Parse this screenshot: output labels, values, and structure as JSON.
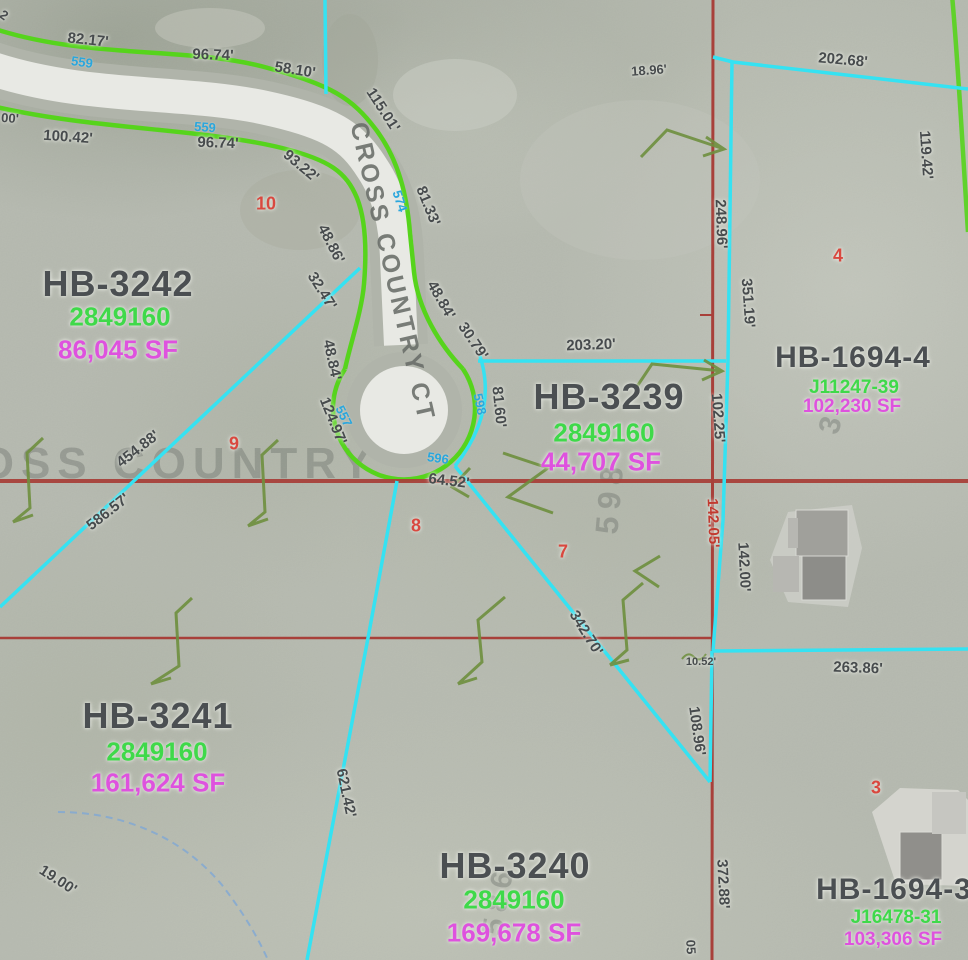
{
  "map_type": "parcel-gis-aerial",
  "colors": {
    "parcel_boundary_cyan": "#35e2f2",
    "section_line_red": "#a8403a",
    "road_edge_green": "#56d41c",
    "contour_label_blue": "#2aa6dd",
    "parcel_id_green": "#3fd94a",
    "area_magenta": "#de52de",
    "lot_number_red": "#d9483f",
    "measurement_gray": "#474b4d",
    "stream_blue": "#7fa8d4",
    "symbol_green": "#6e8f3e"
  },
  "street": {
    "name_on_road": "CROSS COUNTRY CT",
    "x": 392,
    "y": 272,
    "rot": 77,
    "size": 25
  },
  "watermarks": [
    {
      "text": "CROSS COUNTRY",
      "x": 140,
      "y": 464,
      "rot": 0,
      "size": 44
    },
    {
      "text": "598",
      "x": 610,
      "y": 497,
      "rot": -85,
      "size": 32
    },
    {
      "text": "586",
      "x": 499,
      "y": 900,
      "rot": -80,
      "size": 30
    },
    {
      "text": "3",
      "x": 832,
      "y": 422,
      "rot": -75,
      "size": 30
    }
  ],
  "parcels": [
    {
      "name": "HB-3242",
      "pid": "2849160",
      "area": "86,045 SF",
      "nx": 118,
      "ny": 284,
      "ns": 36,
      "px": 120,
      "py": 317,
      "ps": 26,
      "ax": 118,
      "ay": 350,
      "as": 26
    },
    {
      "name": "HB-3239",
      "pid": "2849160",
      "area": "44,707 SF",
      "nx": 609,
      "ny": 397,
      "ns": 36,
      "px": 604,
      "py": 433,
      "ps": 26,
      "ax": 601,
      "ay": 462,
      "as": 26
    },
    {
      "name": "HB-1694-4",
      "pid": "J11247-39",
      "area": "102,230 SF",
      "nx": 853,
      "ny": 358,
      "ns": 30,
      "px": 854,
      "py": 388,
      "ps": 19,
      "ax": 852,
      "ay": 407,
      "as": 19
    },
    {
      "name": "HB-3241",
      "pid": "2849160",
      "area": "161,624 SF",
      "nx": 158,
      "ny": 716,
      "ns": 36,
      "px": 157,
      "py": 752,
      "ps": 26,
      "ax": 158,
      "ay": 783,
      "as": 26
    },
    {
      "name": "HB-3240",
      "pid": "2849160",
      "area": "169,678 SF",
      "nx": 515,
      "ny": 866,
      "ns": 36,
      "px": 514,
      "py": 900,
      "ps": 26,
      "ax": 514,
      "ay": 933,
      "as": 26
    },
    {
      "name": "HB-1694-3",
      "pid": "J16478-31",
      "area": "103,306 SF",
      "nx": 894,
      "ny": 890,
      "ns": 30,
      "px": 896,
      "py": 918,
      "ps": 19,
      "ax": 893,
      "ay": 940,
      "as": 19
    }
  ],
  "lot_numbers": [
    {
      "text": "10",
      "x": 266,
      "y": 204
    },
    {
      "text": "9",
      "x": 234,
      "y": 444
    },
    {
      "text": "8",
      "x": 416,
      "y": 526
    },
    {
      "text": "7",
      "x": 563,
      "y": 552
    },
    {
      "text": "4",
      "x": 838,
      "y": 256
    },
    {
      "text": "3",
      "x": 876,
      "y": 788
    }
  ],
  "measurements": [
    {
      "text": "82.17'",
      "x": 88,
      "y": 40,
      "rot": 6
    },
    {
      "text": "96.74'",
      "x": 213,
      "y": 55,
      "rot": 2
    },
    {
      "text": "58.10'",
      "x": 295,
      "y": 70,
      "rot": 9
    },
    {
      "text": "115.01'",
      "x": 383,
      "y": 110,
      "rot": 57
    },
    {
      "text": "100.42'",
      "x": 68,
      "y": 137,
      "rot": 4
    },
    {
      "text": "96.74'",
      "x": 218,
      "y": 143,
      "rot": 2
    },
    {
      "text": "93.22'",
      "x": 301,
      "y": 166,
      "rot": 40
    },
    {
      "text": "81.33'",
      "x": 428,
      "y": 206,
      "rot": 68
    },
    {
      "text": "48.86'",
      "x": 331,
      "y": 244,
      "rot": 63
    },
    {
      "text": "32.47'",
      "x": 322,
      "y": 291,
      "rot": 58
    },
    {
      "text": "48.84'",
      "x": 441,
      "y": 300,
      "rot": 60
    },
    {
      "text": "30.79'",
      "x": 473,
      "y": 341,
      "rot": 56
    },
    {
      "text": "48.84'",
      "x": 332,
      "y": 360,
      "rot": 78
    },
    {
      "text": "124.97'",
      "x": 333,
      "y": 421,
      "rot": 68
    },
    {
      "text": "81.60'",
      "x": 499,
      "y": 407,
      "rot": 84
    },
    {
      "text": "203.20'",
      "x": 591,
      "y": 345,
      "rot": -2
    },
    {
      "text": "18.96'",
      "x": 649,
      "y": 70,
      "rot": -4,
      "size": 13
    },
    {
      "text": "202.68'",
      "x": 843,
      "y": 60,
      "rot": 5
    },
    {
      "text": "119.42'",
      "x": 926,
      "y": 155,
      "rot": 86
    },
    {
      "text": "248.96'",
      "x": 721,
      "y": 224,
      "rot": 88
    },
    {
      "text": "351.19'",
      "x": 748,
      "y": 303,
      "rot": 86
    },
    {
      "text": "102.25'",
      "x": 718,
      "y": 418,
      "rot": 86
    },
    {
      "text": "454.88'",
      "x": 138,
      "y": 449,
      "rot": -38
    },
    {
      "text": "586.57'",
      "x": 108,
      "y": 512,
      "rot": -38
    },
    {
      "text": "64.52'",
      "x": 449,
      "y": 481,
      "rot": 7
    },
    {
      "text": "342.70'",
      "x": 586,
      "y": 633,
      "rot": 58
    },
    {
      "text": "142.05'",
      "x": 713,
      "y": 523,
      "rot": 88,
      "red": true
    },
    {
      "text": "142.00'",
      "x": 744,
      "y": 567,
      "rot": 87
    },
    {
      "text": "10.52'",
      "x": 701,
      "y": 662,
      "rot": 0,
      "size": 11
    },
    {
      "text": "263.86'",
      "x": 858,
      "y": 668,
      "rot": 2
    },
    {
      "text": "108.96'",
      "x": 697,
      "y": 731,
      "rot": 82
    },
    {
      "text": "372.88'",
      "x": 723,
      "y": 884,
      "rot": 87
    },
    {
      "text": "621.42'",
      "x": 346,
      "y": 793,
      "rot": 78
    },
    {
      "text": "19.00'",
      "x": 58,
      "y": 880,
      "rot": 33
    },
    {
      "text": "05",
      "x": 691,
      "y": 947,
      "rot": 87,
      "size": 13
    },
    {
      "text": "00'",
      "x": 10,
      "y": 118,
      "rot": 4,
      "size": 13
    },
    {
      "text": "2",
      "x": 4,
      "y": 15,
      "rot": 35,
      "size": 13
    }
  ],
  "contour_labels": [
    {
      "text": "559",
      "x": 82,
      "y": 62,
      "rot": 8
    },
    {
      "text": "559",
      "x": 205,
      "y": 127,
      "rot": 4
    },
    {
      "text": "574",
      "x": 400,
      "y": 201,
      "rot": 72
    },
    {
      "text": "557",
      "x": 344,
      "y": 416,
      "rot": 64
    },
    {
      "text": "596",
      "x": 438,
      "y": 458,
      "rot": 8
    },
    {
      "text": "598",
      "x": 480,
      "y": 404,
      "rot": 78
    }
  ]
}
